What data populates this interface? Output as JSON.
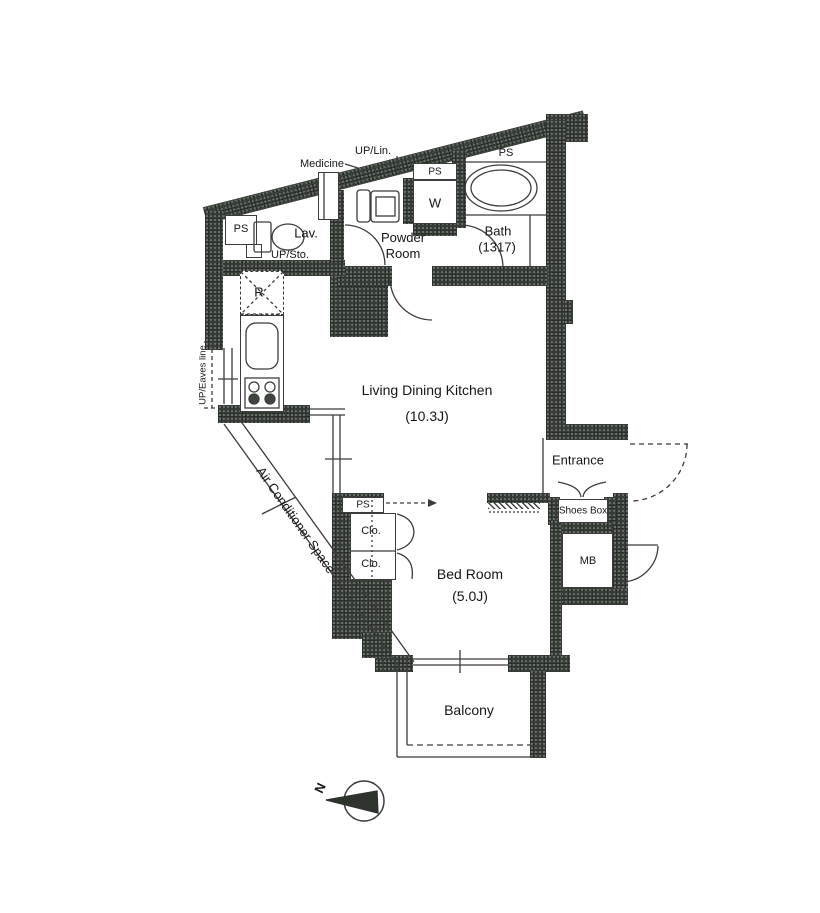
{
  "title": "Apartment floor plan",
  "colors": {
    "wall": "#3e463e",
    "line": "#3c3c3c",
    "background": "#ffffff",
    "text": "#161616"
  },
  "rooms": {
    "ldk": {
      "name": "Living Dining Kitchen",
      "size": "(10.3J)"
    },
    "bedroom": {
      "name": "Bed Room",
      "size": "(5.0J)"
    },
    "bath": {
      "name": "Bath",
      "size": "(1317)"
    },
    "powder_room": {
      "name": "Powder Room"
    },
    "lavatory": {
      "name": "Lav."
    },
    "entrance": {
      "name": "Entrance"
    },
    "balcony": {
      "name": "Balcony"
    }
  },
  "labels": {
    "medicine": "Medicine",
    "up_lin": "UP/Lin.",
    "up_sto": "UP/Sto.",
    "up_eaves_line": "UP/Eaves line",
    "air_conditioner_space": "Air Conditioner Space",
    "shoes_box": "Shoes Box",
    "meter_box": "MB",
    "refrigerator": "R",
    "washer": "W",
    "closet_upper": "Clo.",
    "closet_lower": "Clo.",
    "ps_lav": "PS",
    "ps_powder": "PS",
    "ps_bath": "PS",
    "ps_closet": "PS",
    "compass_north": "N"
  }
}
